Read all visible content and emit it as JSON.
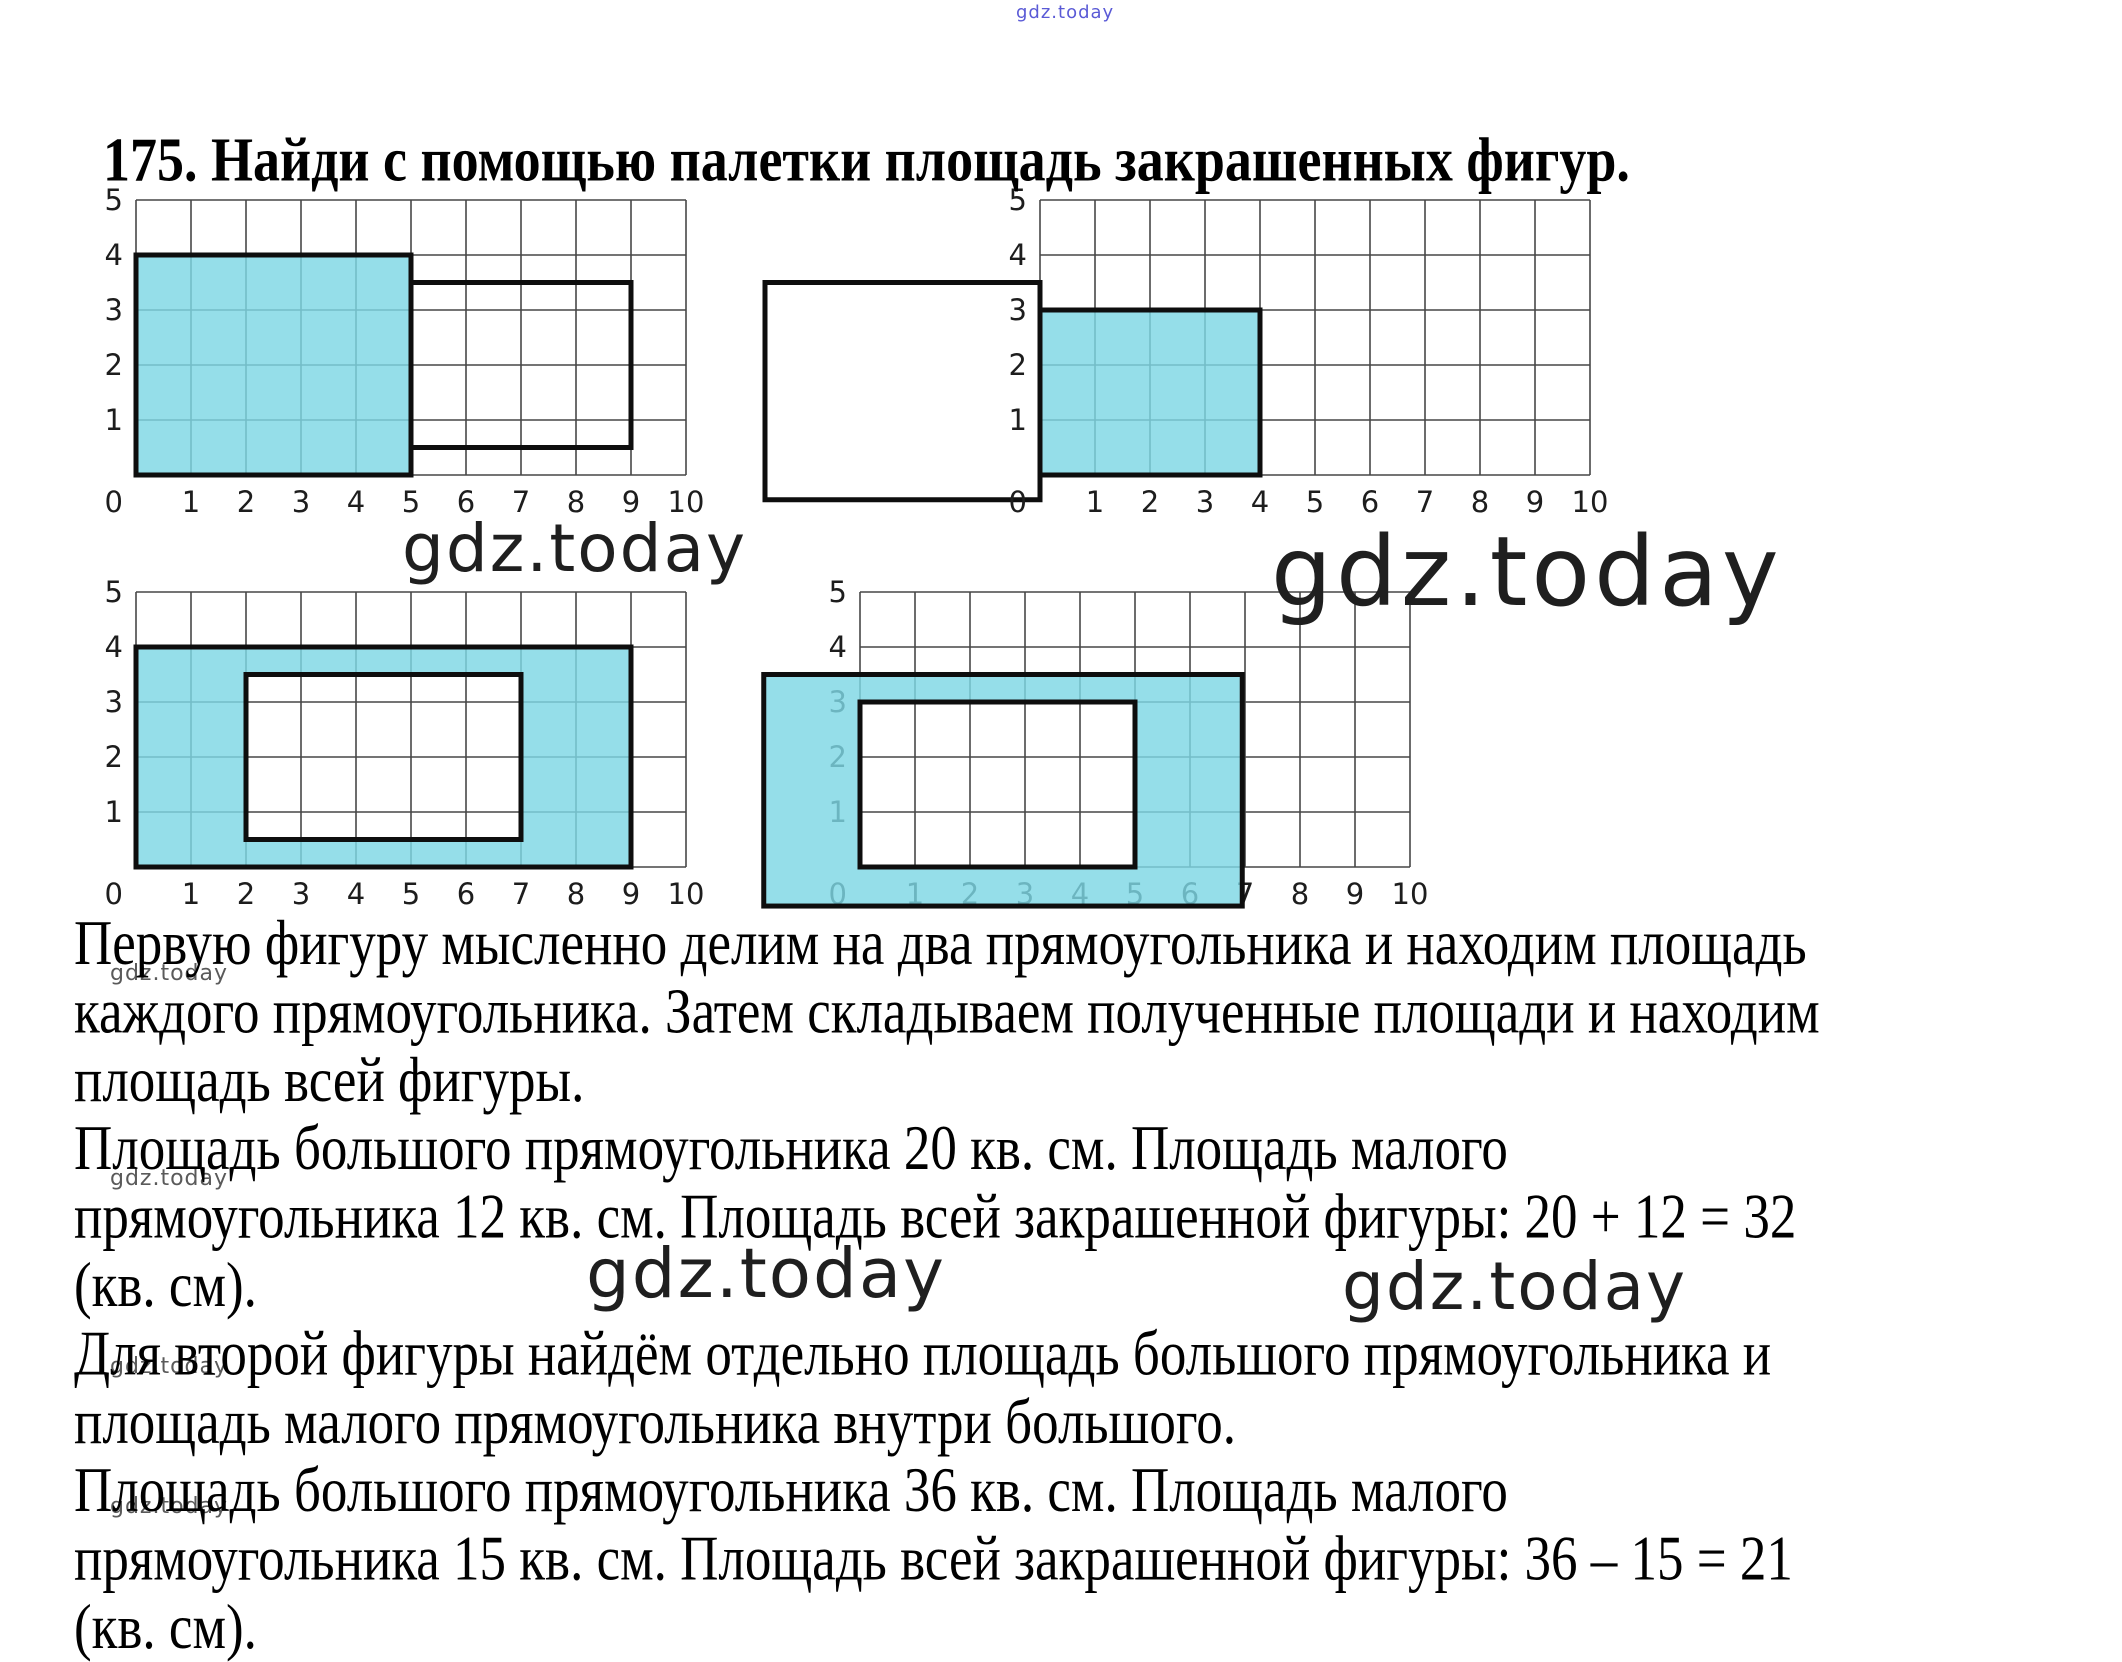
{
  "title": "175. Найди с помощью палетки площадь закрашенных фигур.",
  "watermark": {
    "text": "gdz.today",
    "top_color": "#5a5ad6",
    "large_color": "#1f1f1f",
    "small_color": "#5a5a5a"
  },
  "solution": {
    "lines": [
      "Первую фигуру мысленно делим на два прямоугольника и находим площадь",
      "каждого прямоугольника. Затем складываем полученные площади и находим",
      "площадь всей фигуры.",
      "Площадь большого прямоугольника 20 кв. см. Площадь малого",
      "прямоугольника 12 кв. см. Площадь всей закрашенной фигуры: 20 + 12 = 32",
      "(кв. см).",
      "Для второй фигуры найдём отдельно площадь большого прямоугольника и",
      "площадь малого прямоугольника внутри большого.",
      "Площадь большого прямоугольника 36 кв. см. Площадь малого",
      "прямоугольника 15 кв. см. Площадь всей закрашенной фигуры: 36 – 15 = 21",
      "(кв. см)."
    ]
  },
  "diagrams": {
    "axis_x": [
      "0",
      "1",
      "2",
      "3",
      "4",
      "5",
      "6",
      "7",
      "8",
      "9",
      "10"
    ],
    "axis_y_top_down": [
      "5",
      "4",
      "3",
      "2",
      "1"
    ],
    "origin_label": "0",
    "colors": {
      "shade": "#7ed7e4",
      "grid_line": "#474747",
      "outline": "#0e0e0e",
      "label": "#1d1d1d"
    },
    "figures": {
      "d1": {
        "desc": "Figure 1 on palette: shaded 5x4 rectangle (area 20) with attached outlined 4x3 rectangle (area 12)",
        "shaded_rects": [
          [
            0,
            0,
            5,
            4
          ]
        ],
        "outline_rects": [
          [
            0,
            0,
            5,
            4
          ],
          [
            5,
            0.5,
            9,
            3.5
          ]
        ]
      },
      "d2": {
        "desc": "Shaded 4x3 rectangle (area 12) on palette; outlined white 5x4 rectangle off palette at left",
        "shaded_rects": [
          [
            0,
            0,
            4,
            3
          ]
        ],
        "outline_rects": [
          [
            0,
            0,
            4,
            3
          ]
        ],
        "white_rects": [
          [
            -5,
            -0.45,
            0,
            3.5
          ]
        ]
      },
      "d3": {
        "desc": "Figure 2 on palette: shaded 9x4 frame (area 36) with 5x3 hole (area 15), result 21",
        "rings": [
          {
            "outer": [
              0,
              0,
              9,
              4
            ],
            "hole": [
              2,
              0.5,
              7,
              3.5
            ]
          }
        ]
      },
      "d4": {
        "desc": "Figure 2 shifted partly off palette: shaded frame with 5x3 hole aligned to grid",
        "rings": [
          {
            "outer": [
              -1.75,
              -0.71,
              6.95,
              3.5
            ],
            "hole": [
              0,
              0,
              5,
              3
            ]
          }
        ]
      }
    }
  }
}
